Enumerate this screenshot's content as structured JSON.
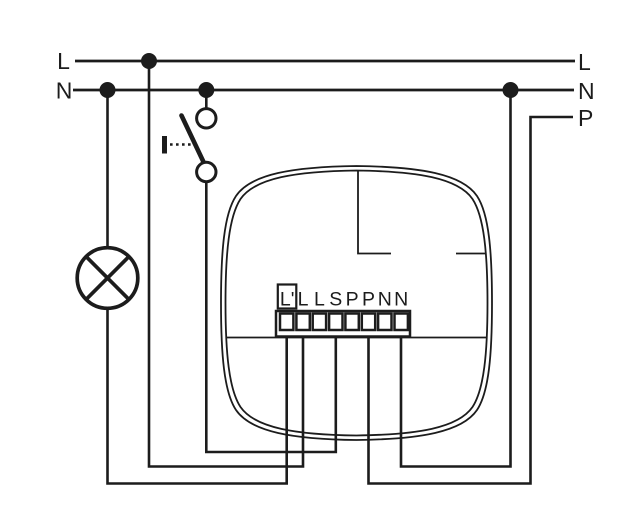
{
  "bus": {
    "left": {
      "line": "L",
      "neutral": "N"
    },
    "right": {
      "line": "L",
      "neutral": "N",
      "pilot": "P"
    }
  },
  "terminal_block": {
    "labels": [
      "L'",
      "L",
      "L",
      "S",
      "P",
      "P",
      "N",
      "N"
    ]
  },
  "icons": {
    "lamp": "lamp-icon",
    "push_switch": "push-switch-icon",
    "junction": "junction-dot"
  },
  "colors": {
    "stroke": "#1c1c1c",
    "background": "#ffffff"
  }
}
